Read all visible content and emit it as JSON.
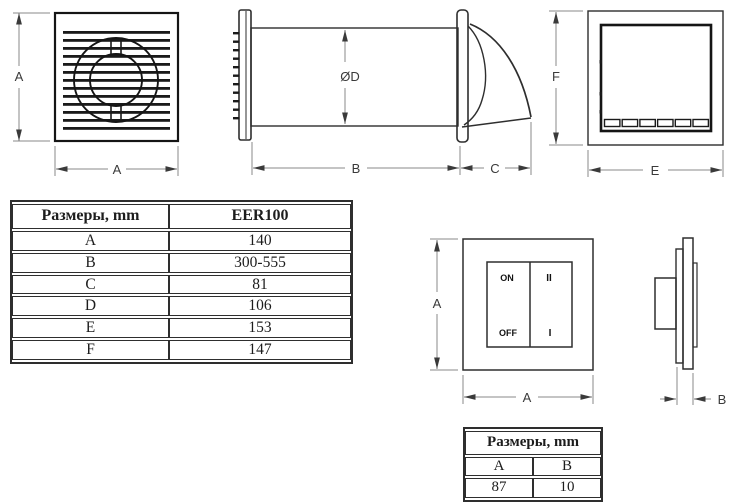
{
  "colors": {
    "drawing_line": "#2e2e2e",
    "thick_line": "#151515",
    "dim_line": "#8a8a8a",
    "text": "#1d1d1d"
  },
  "dimension_labels": {
    "front_a_vertical": "A",
    "front_a_horizontal": "A",
    "side_diameter": "ØD",
    "side_b": "B",
    "side_c": "C",
    "back_f": "F",
    "back_e": "E",
    "switch_a_vertical": "A",
    "switch_a_horizontal": "A",
    "switch_side_b": "B"
  },
  "switch_labels": {
    "on": "ON",
    "off": "OFF",
    "speed_2": "II",
    "speed_1": "I"
  },
  "main_table": {
    "col1_header": "Размеры, mm",
    "col2_header": "EER100",
    "rows": [
      {
        "dim": "A",
        "value": "140"
      },
      {
        "dim": "B",
        "value": "300-555"
      },
      {
        "dim": "C",
        "value": "81"
      },
      {
        "dim": "D",
        "value": "106"
      },
      {
        "dim": "E",
        "value": "153"
      },
      {
        "dim": "F",
        "value": "147"
      }
    ]
  },
  "switch_table": {
    "title": "Размеры, mm",
    "col_a": "A",
    "col_b": "B",
    "val_a": "87",
    "val_b": "10"
  }
}
